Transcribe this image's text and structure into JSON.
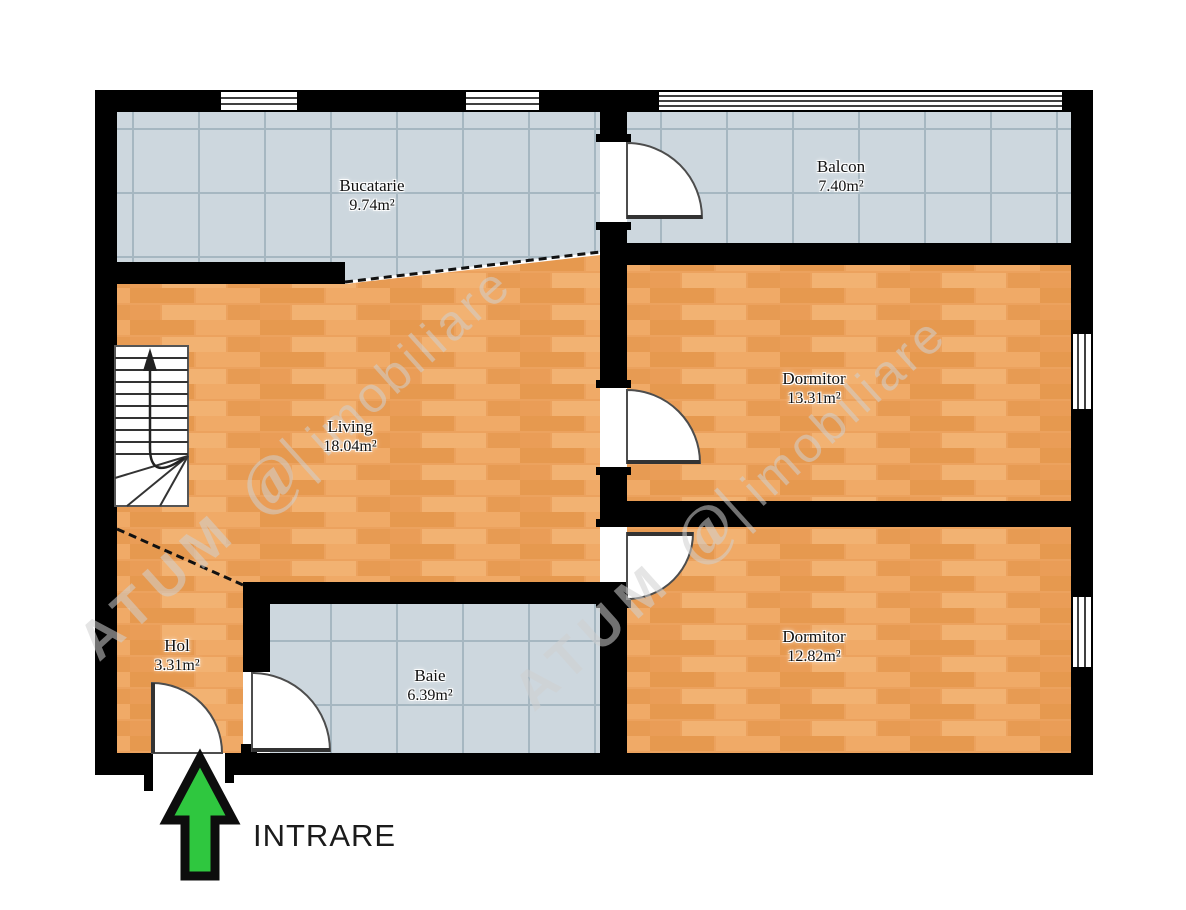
{
  "plan": {
    "rooms": [
      {
        "name": "Bucatarie",
        "area": "9.74m²"
      },
      {
        "name": "Balcon",
        "area": "7.40m²"
      },
      {
        "name": "Living",
        "area": "18.04m²"
      },
      {
        "name": "Dormitor",
        "area": "13.31m²"
      },
      {
        "name": "Hol",
        "area": "3.31m²"
      },
      {
        "name": "Baie",
        "area": "6.39m²"
      },
      {
        "name": "Dormitor",
        "area": "12.82m²"
      }
    ],
    "entrance_label": "INTRARE",
    "watermark": {
      "brand": "ATUM",
      "logo": "@|",
      "name": "imobiliare"
    },
    "colors": {
      "wall": "#000000",
      "tile_floor": "#cdd7de",
      "tile_grid": "#a6b7c1",
      "wood_floor": "#eca25e",
      "arrow_green": "#2fc73f",
      "label_text": "#111111"
    }
  }
}
